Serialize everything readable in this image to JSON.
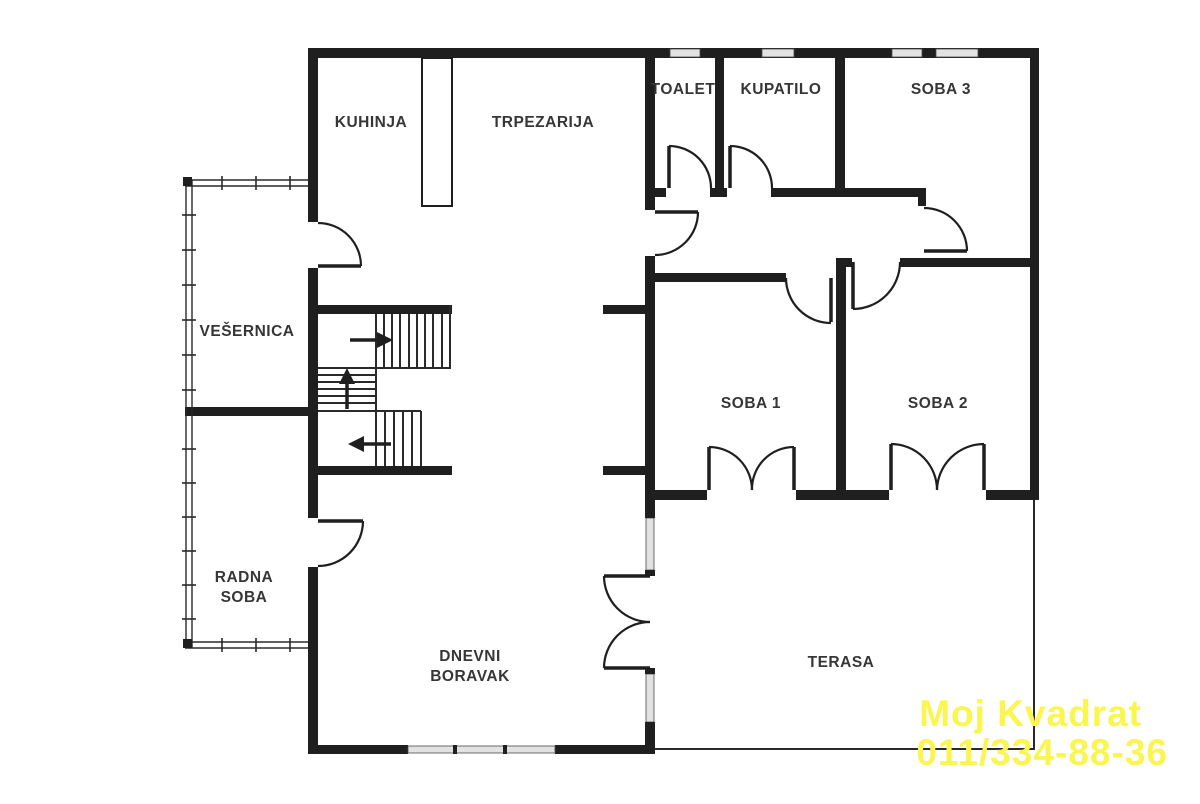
{
  "floorplan": {
    "rooms": {
      "kuhinja": "KUHINJA",
      "trpezarija": "TRPEZARIJA",
      "toalet": "TOALET",
      "kupatilo": "KUPATILO",
      "soba3": "SOBA 3",
      "vesernica": "VEŠERNICA",
      "soba1": "SOBA 1",
      "soba2": "SOBA 2",
      "radna_soba_line1": "RADNA",
      "radna_soba_line2": "SOBA",
      "dnevni_boravak_line1": "DNEVNI",
      "dnevni_boravak_line2": "BORAVAK",
      "terasa": "TERASA"
    },
    "staircase": {
      "direction_arrows": [
        "right",
        "up",
        "left"
      ]
    },
    "watermark": {
      "line1": "Moj Kvadrat",
      "line2": "011/334-88-36",
      "color": "#faf54f"
    },
    "colors": {
      "wall": "#1f1f1f",
      "background": "#ffffff",
      "label": "#363636",
      "window_fill": "#e2e2e2"
    }
  }
}
